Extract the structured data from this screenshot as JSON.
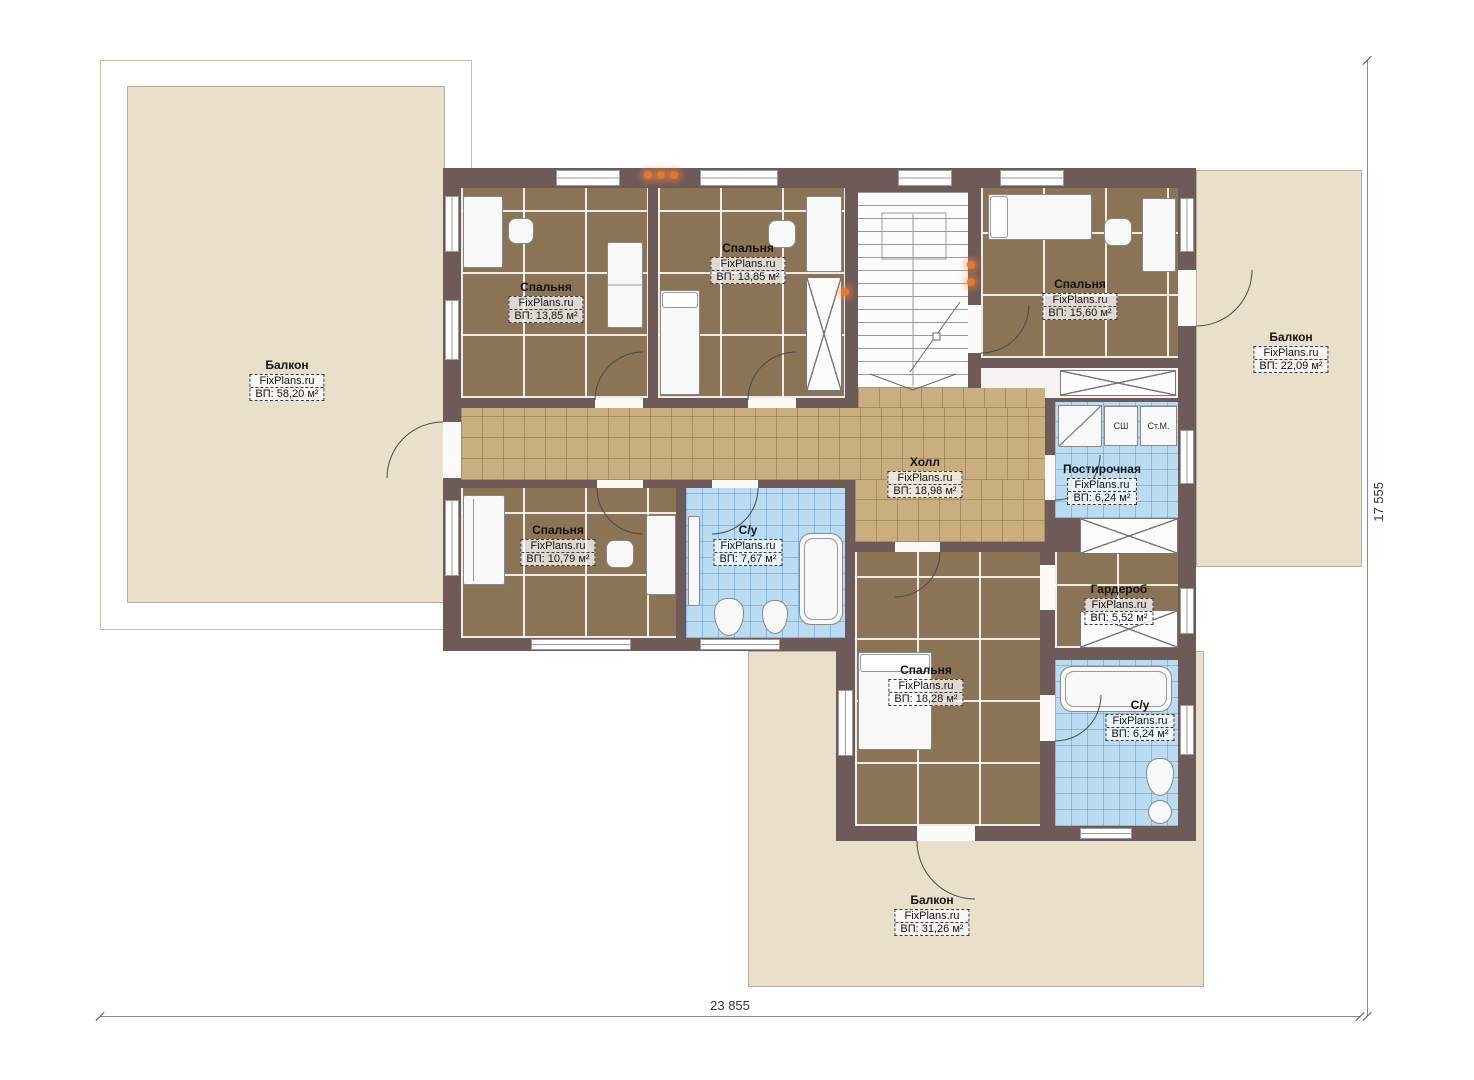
{
  "plan": {
    "watermark": "FixPlans.ru",
    "rooms": [
      {
        "name": "Балкон",
        "area": "ВП: 58,20 м²"
      },
      {
        "name": "Спальня",
        "area": "ВП: 13,85 м²"
      },
      {
        "name": "Спальня",
        "area": "ВП: 13,85 м²"
      },
      {
        "name": "Спальня",
        "area": "ВП: 15,60 м²"
      },
      {
        "name": "Балкон",
        "area": "ВП: 22,09 м²"
      },
      {
        "name": "Холл",
        "area": "ВП: 18,98 м²"
      },
      {
        "name": "Постирочная",
        "area": "ВП: 6,24 м²"
      },
      {
        "name": "Спальня",
        "area": "ВП: 10,79 м²"
      },
      {
        "name": "С/у",
        "area": "ВП: 7,67 м²"
      },
      {
        "name": "Гардероб",
        "area": "ВП: 5,52 м²"
      },
      {
        "name": "Спальня",
        "area": "ВП: 18,28 м²"
      },
      {
        "name": "С/у",
        "area": "ВП: 6,24 м²"
      },
      {
        "name": "Балкон",
        "area": "ВП: 31,26 м²"
      }
    ],
    "appliances": {
      "dryer_label": "СШ",
      "washer_label": "Ст.М."
    },
    "dimensions": {
      "width_label": "23 855",
      "height_label": "17 555"
    },
    "colors": {
      "wall": "#6e5a58",
      "carpet": "#8b7456",
      "tile": "#c9ae80",
      "bathroom": "#badcf2",
      "balcony": "#e9dfcb",
      "light_dot": "#e9762d"
    }
  }
}
